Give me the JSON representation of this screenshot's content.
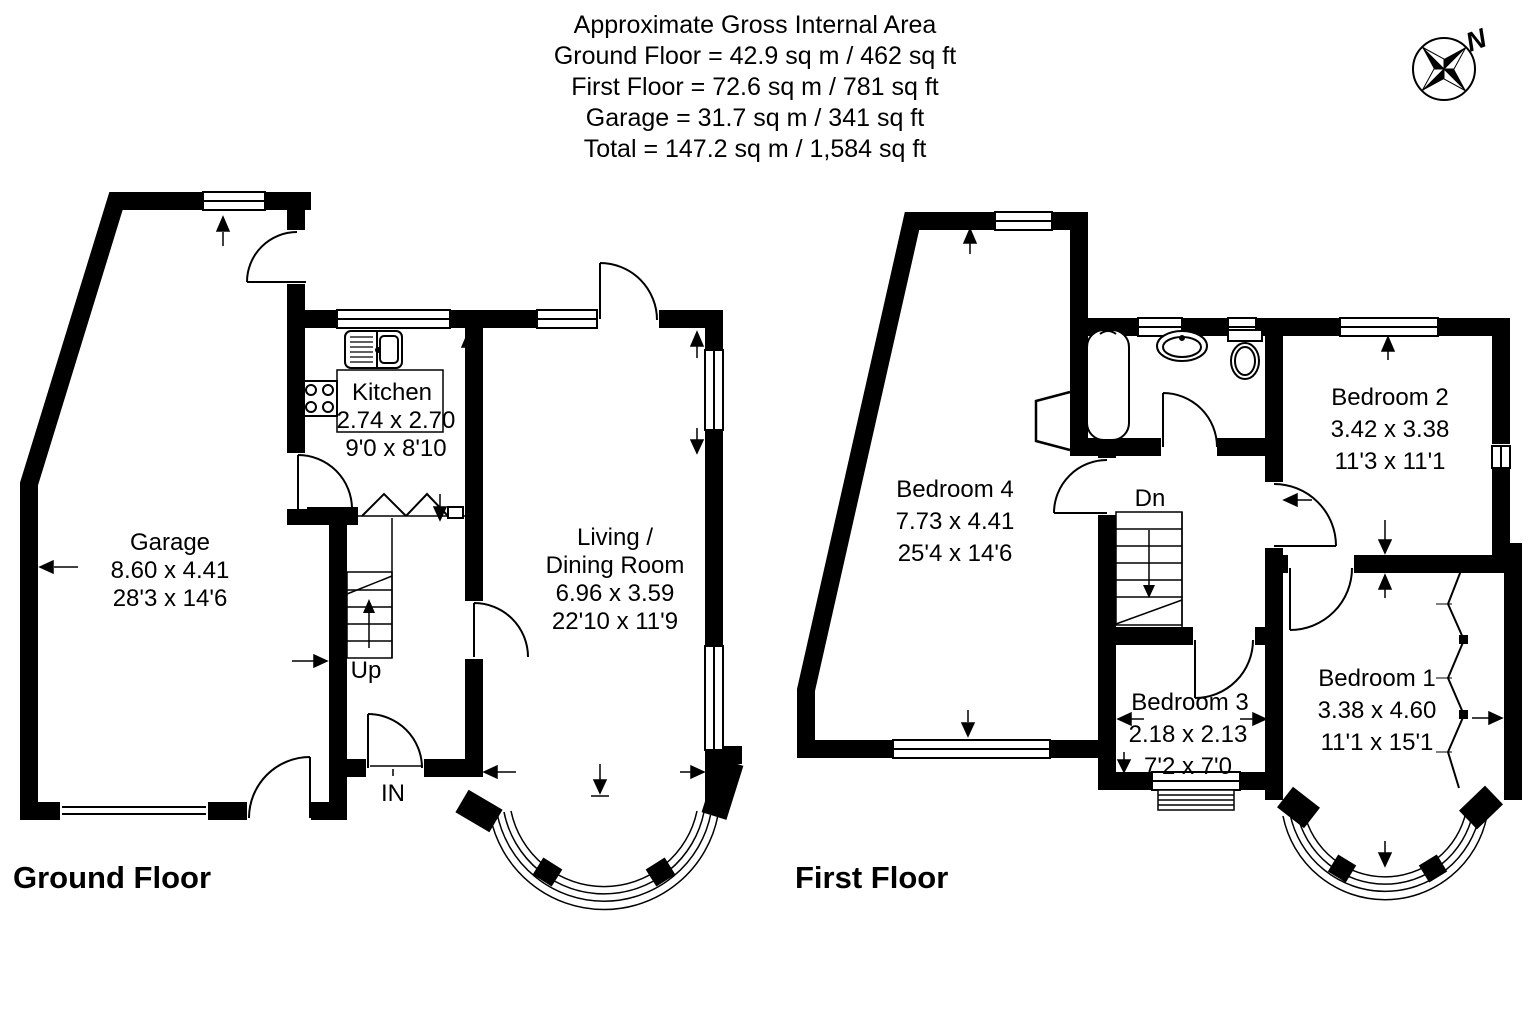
{
  "header": {
    "lines": [
      "Approximate Gross Internal Area",
      "Ground Floor = 42.9 sq m / 462 sq ft",
      "First Floor = 72.6 sq m / 781 sq ft",
      "Garage = 31.7 sq m / 341 sq ft",
      "Total = 147.2 sq m / 1,584 sq ft"
    ]
  },
  "compass": {
    "north": "N"
  },
  "ground_floor": {
    "title": "Ground Floor",
    "stairs_label": "Up",
    "entrance_label": "IN",
    "rooms": {
      "garage": {
        "name": "Garage",
        "dim_m": "8.60 x 4.41",
        "dim_ft": "28'3 x 14'6"
      },
      "kitchen": {
        "name": "Kitchen",
        "dim_m": "2.74 x 2.70",
        "dim_ft": "9'0 x 8'10"
      },
      "living_dining": {
        "name_line1": "Living /",
        "name_line2": "Dining Room",
        "dim_m": "6.96 x 3.59",
        "dim_ft": "22'10 x 11'9"
      }
    }
  },
  "first_floor": {
    "title": "First Floor",
    "stairs_label": "Dn",
    "rooms": {
      "bedroom4": {
        "name": "Bedroom 4",
        "dim_m": "7.73 x 4.41",
        "dim_ft": "25'4 x 14'6"
      },
      "bedroom2": {
        "name": "Bedroom 2",
        "dim_m": "3.42 x 3.38",
        "dim_ft": "11'3 x 11'1"
      },
      "bedroom3": {
        "name": "Bedroom 3",
        "dim_m": "2.18 x 2.13",
        "dim_ft": "7'2 x 7'0"
      },
      "bedroom1": {
        "name": "Bedroom 1",
        "dim_m": "3.38 x 4.60",
        "dim_ft": "11'1 x 15'1"
      }
    }
  },
  "colors": {
    "wall": "#000000",
    "background": "#ffffff"
  }
}
